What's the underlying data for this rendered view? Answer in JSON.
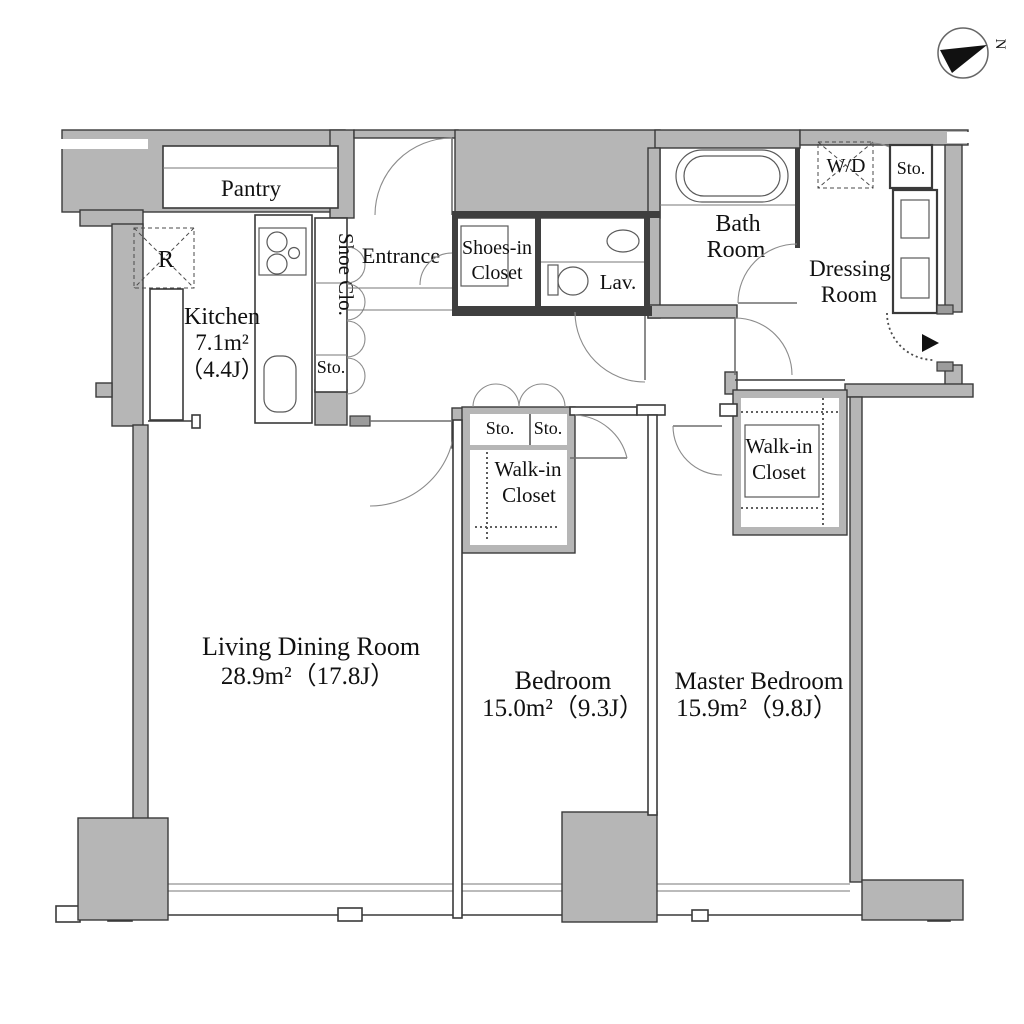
{
  "title": "Apartment floor plan",
  "compass": {
    "label": "N"
  },
  "colors": {
    "wall_fill": "#b6b6b6",
    "wall_line": "#3a3a3a",
    "text": "#111111",
    "background": "#ffffff"
  },
  "rooms": {
    "pantry": {
      "label": "Pantry"
    },
    "refrigerator": {
      "label": "R"
    },
    "kitchen": {
      "name": "Kitchen",
      "area_m2": "7.1m²",
      "area_j": "（4.4J）"
    },
    "shoe_closet": {
      "label": "Shoe Clo."
    },
    "hall_storage": {
      "label": "Sto."
    },
    "entrance": {
      "label": "Entrance"
    },
    "shoes_in_closet": {
      "line1": "Shoes-in",
      "line2": "Closet"
    },
    "lavatory": {
      "label": "Lav."
    },
    "bath_room": {
      "line1": "Bath",
      "line2": "Room"
    },
    "washer_dryer": {
      "label": "W/D"
    },
    "storage_top": {
      "label": "Sto."
    },
    "dressing_room": {
      "line1": "Dressing",
      "line2": "Room"
    },
    "storage_mid_left": {
      "label": "Sto."
    },
    "storage_mid_right": {
      "label": "Sto."
    },
    "walk_in_closet_bedroom": {
      "line1": "Walk-in",
      "line2": "Closet"
    },
    "walk_in_closet_master": {
      "line1": "Walk-in",
      "line2": "Closet"
    },
    "living_dining": {
      "name": "Living Dining Room",
      "area": "28.9m²（17.8J）"
    },
    "bedroom": {
      "name": "Bedroom",
      "area": "15.0m²（9.3J）"
    },
    "master_bedroom": {
      "name": "Master Bedroom",
      "area": "15.9m²（9.8J）"
    }
  }
}
